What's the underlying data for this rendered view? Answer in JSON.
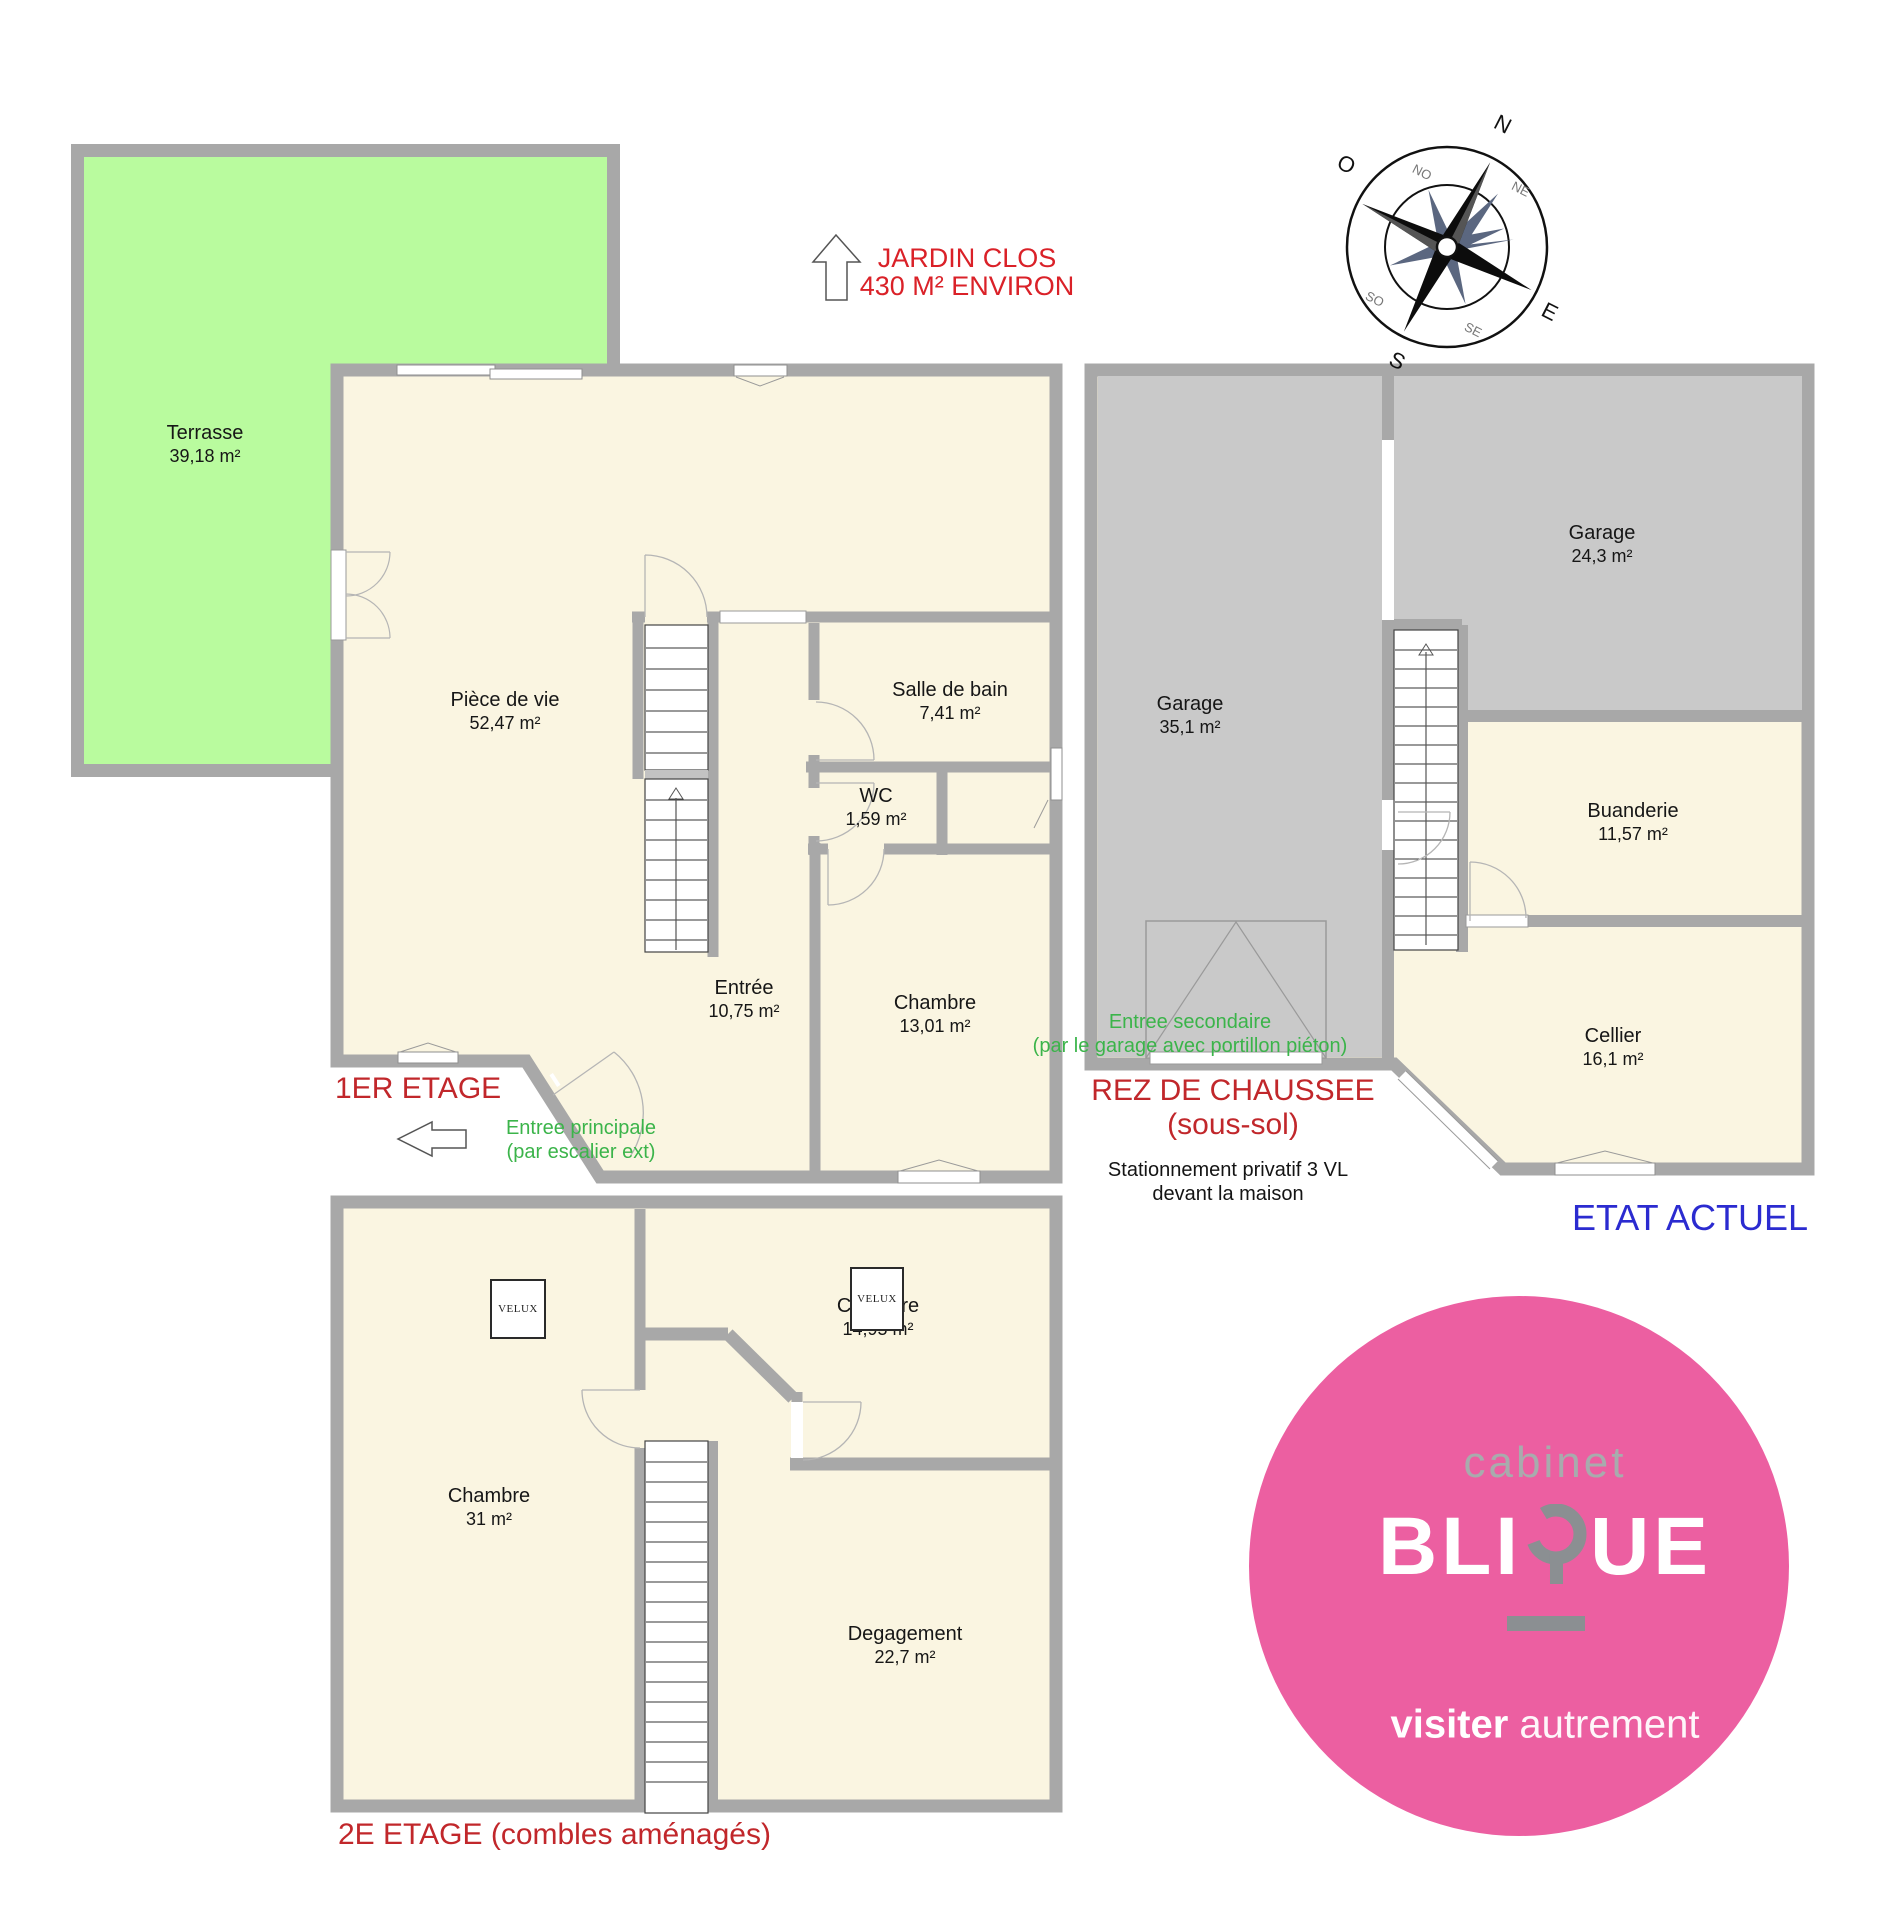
{
  "terrasse": {
    "name": "Terrasse",
    "area": "39,18 m²"
  },
  "floor1": {
    "title": "1ER ETAGE",
    "rooms": {
      "piece_de_vie": {
        "name": "Pièce de vie",
        "area": "52,47 m²"
      },
      "salle_de_bain": {
        "name": "Salle de bain",
        "area": "7,41 m²"
      },
      "wc": {
        "name": "WC",
        "area": "1,59 m²"
      },
      "entree": {
        "name": "Entrée",
        "area": "10,75 m²"
      },
      "chambre": {
        "name": "Chambre",
        "area": "13,01 m²"
      }
    }
  },
  "rdc": {
    "title": "REZ DE CHAUSSEE",
    "subtitle": "(sous-sol)",
    "rooms": {
      "garage1": {
        "name": "Garage",
        "area": "35,1 m²"
      },
      "garage2": {
        "name": "Garage",
        "area": "24,3 m²"
      },
      "buanderie": {
        "name": "Buanderie",
        "area": "11,57 m²"
      },
      "cellier": {
        "name": "Cellier",
        "area": "16,1 m²"
      }
    }
  },
  "floor2": {
    "title": "2E ETAGE (combles aménagés)",
    "rooms": {
      "chambre1": {
        "name": "Chambre",
        "area": "31 m²"
      },
      "chambre2": {
        "name": "Chambre",
        "area": "14,95 m²"
      },
      "degagement": {
        "name": "Degagement",
        "area": "22,7 m²"
      }
    }
  },
  "annotations": {
    "jardin_line1": "JARDIN CLOS",
    "jardin_line2": "430 M² ENVIRON",
    "entree_principale_line1": "Entree principale",
    "entree_principale_line2": "(par escalier ext)",
    "entree_secondaire_line1": "Entree secondaire",
    "entree_secondaire_line2": "(par le garage avec portillon piéton)",
    "stationnement_line1": "Stationnement privatif 3 VL",
    "stationnement_line2": "devant la maison",
    "etat_actuel": "ETAT ACTUEL"
  },
  "velux_label": "VELUX",
  "compass": {
    "n": "N",
    "ne": "NE",
    "e": "E",
    "se": "SE",
    "s": "S",
    "so": "SO",
    "o": "O",
    "no": "NO"
  },
  "logo": {
    "line1": "cabinet",
    "brand_left": "BLI",
    "brand_right": "UE",
    "tagline_bold": "visiter",
    "tagline_light": " autrement"
  },
  "colors": {
    "terrace_green": "#b9fb9e",
    "room_cream": "#faf5e1",
    "garage_gray": "#c9c9c9",
    "wall_gray": "#a8a8a8",
    "title_red": "#c1272b",
    "accent_red": "#da2128",
    "green_text": "#3bb44a",
    "blue_text": "#2b2bd0",
    "logo_pink": "#ec5fa1",
    "logo_gray": "#8b8f92"
  }
}
